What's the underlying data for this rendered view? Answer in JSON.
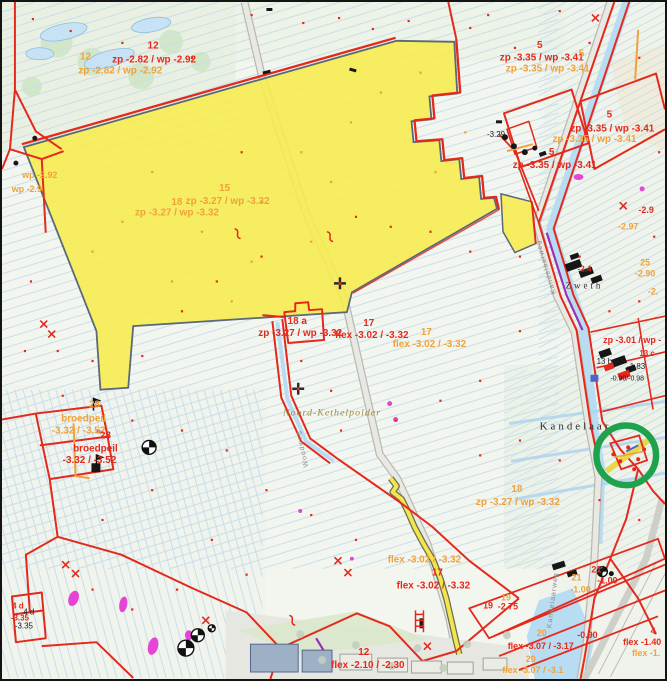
{
  "map": {
    "labels": [
      "12",
      "zp -2.82 / wp -2.92",
      "12",
      "zp -2.82 / wp -2.92",
      "5",
      "zp -3.35 / wp -3.41",
      "5",
      "zp -3.35 / wp -3.41",
      "5",
      "zp -3.35 / wp -3.41",
      "zp -3.35 / wp -3.41",
      "5",
      "zp -3.35 / wp -3.41",
      "-3.29",
      "-2.9",
      "-2.97",
      "25",
      "-2.90",
      "-2.",
      "15",
      "18",
      "zp -3.27 / wp -3.32",
      "zp -3.27 / wp -3.32",
      "wp -2.92",
      "wp -2.9",
      "18 a",
      "zp -3.27 / wp -3.32",
      "17",
      "flex -3.02 / -3.32",
      "17",
      "flex -3.02 / -3.32",
      "Zweth",
      "-2.4",
      "zp -3.01 / wp -",
      "13 c",
      "13 b",
      "-1.83",
      "-0.90/-0.98",
      "Kandelaar",
      "Noord-Kethelpolder",
      "28",
      "broedpeil",
      "-3.32 / -3.52",
      "28",
      "broedpeil",
      "-3.32 / -3.52",
      "18",
      "zp -3.27 / wp -3.32",
      "flex -3.02 / -3.32",
      "17",
      "flex -3.02 / -3.32",
      "19",
      "19",
      "-2.75",
      "21",
      "-1.00",
      "21",
      "-1.00",
      "-0.90",
      "20",
      "flex -3.07 / -3.17",
      "20",
      "flex -3.07 / -3.1",
      "4",
      "flex -1.40",
      "flex -1.",
      "12",
      "flex -2.10 / -2.30",
      "4 d",
      "4 d",
      "-3.35",
      "-3.35",
      "Kandelaarweg",
      "Kandelaarweg",
      "Woudweg"
    ],
    "annotation": {
      "shape": "circle",
      "color": "#1fa24c"
    },
    "colors": {
      "highlighted_parcel_fill": "#f7ec4d",
      "boundary_red": "#e4291c",
      "boundary_orange": "#efa23b",
      "annotation_circle_green": "#1fa24c",
      "water_blue": "#b8dcf2",
      "greenhouse_magenta": "#e545d6",
      "road_purple": "#9b30b5"
    }
  }
}
